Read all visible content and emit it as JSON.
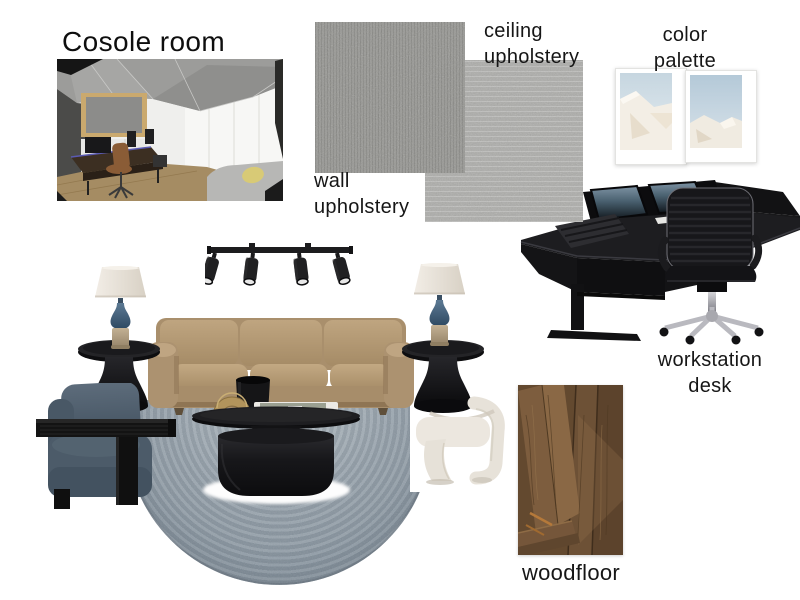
{
  "board": {
    "title": "Cosole room"
  },
  "labels": {
    "ceiling_upholstery": "ceiling upholstery",
    "wall_upholstery": "wall upholstery",
    "color_palette": "color palette",
    "workstation_desk": "workstation desk",
    "woodfloor": "woodfloor"
  },
  "colors": {
    "page_background": "#ffffff",
    "text": "#161616",
    "wall_swatch_grey": "#8f8f8b",
    "ceiling_swatch_grey": "#b5b5b2",
    "sofa_tan": "#b49a76",
    "rug_blue_grey": "#95a1ab",
    "armchair_blue": "#4e5d6b",
    "accent_chair_cream": "#eae6de",
    "furniture_black": "#1a1a1c",
    "lamp_body_blue": "#46617d",
    "lamp_base_tan": "#b5a284",
    "wood_floor_brown": "#6e5138",
    "desk_screen_blue": "#4a5f70",
    "chrome": "#b9b9bf"
  }
}
